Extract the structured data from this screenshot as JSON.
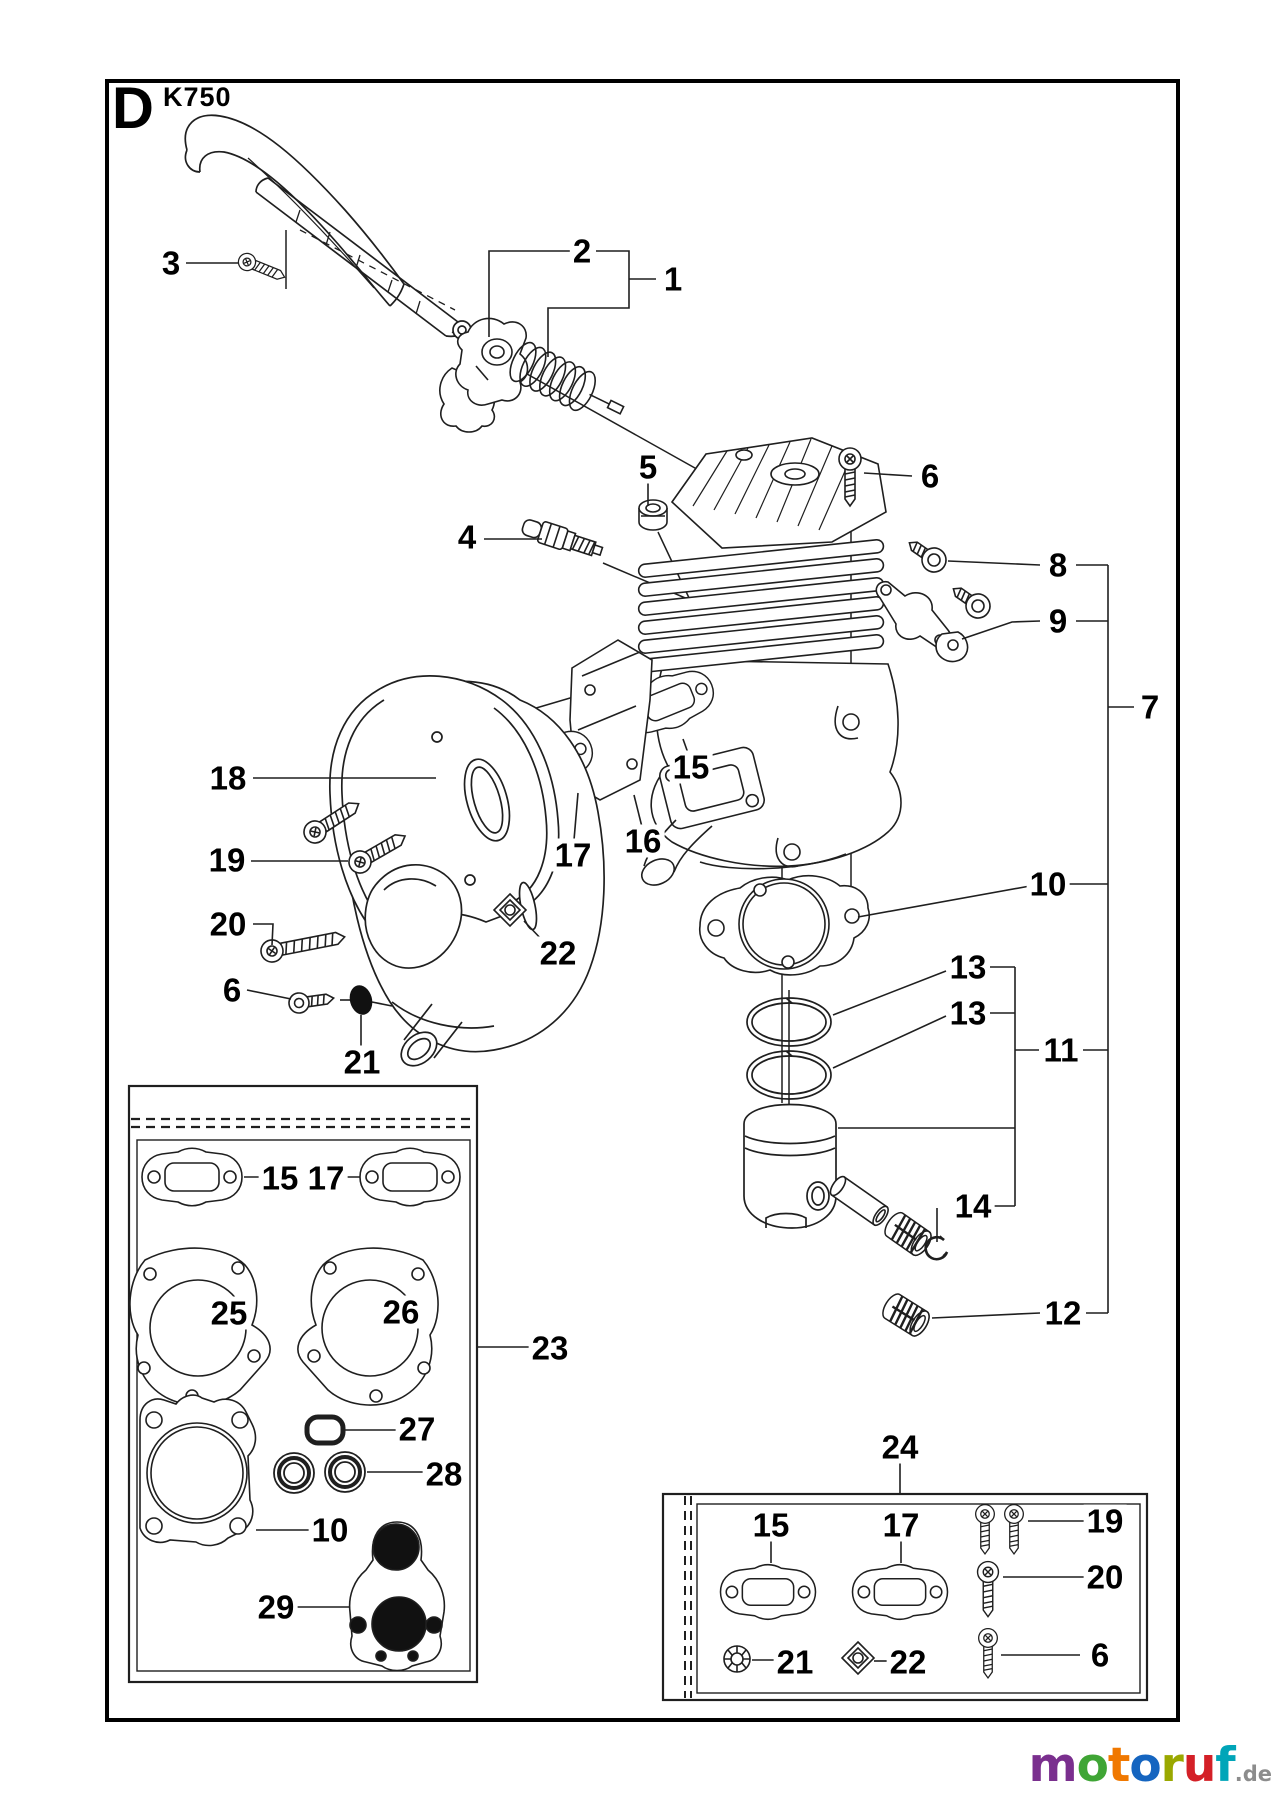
{
  "sheet": {
    "letter": "D",
    "model": "K750"
  },
  "diagram": {
    "line_color": "#1f1f1f",
    "background": "#ffffff",
    "callouts": [
      {
        "n": "3",
        "x": 171,
        "y": 263
      },
      {
        "n": "2",
        "x": 582,
        "y": 251
      },
      {
        "n": "1",
        "x": 673,
        "y": 279
      },
      {
        "n": "5",
        "x": 648,
        "y": 467
      },
      {
        "n": "4",
        "x": 467,
        "y": 537
      },
      {
        "n": "6",
        "x": 930,
        "y": 476
      },
      {
        "n": "8",
        "x": 1058,
        "y": 565
      },
      {
        "n": "9",
        "x": 1058,
        "y": 621
      },
      {
        "n": "7",
        "x": 1150,
        "y": 707
      },
      {
        "n": "15",
        "x": 691,
        "y": 767
      },
      {
        "n": "16",
        "x": 643,
        "y": 841
      },
      {
        "n": "17",
        "x": 573,
        "y": 855
      },
      {
        "n": "18",
        "x": 228,
        "y": 778
      },
      {
        "n": "19",
        "x": 227,
        "y": 860
      },
      {
        "n": "20",
        "x": 228,
        "y": 924
      },
      {
        "n": "6",
        "x": 232,
        "y": 990
      },
      {
        "n": "21",
        "x": 362,
        "y": 1062
      },
      {
        "n": "22",
        "x": 558,
        "y": 953
      },
      {
        "n": "10",
        "x": 1048,
        "y": 884
      },
      {
        "n": "13",
        "x": 968,
        "y": 967
      },
      {
        "n": "13",
        "x": 968,
        "y": 1013
      },
      {
        "n": "11",
        "x": 1061,
        "y": 1050
      },
      {
        "n": "14",
        "x": 973,
        "y": 1206
      },
      {
        "n": "12",
        "x": 1063,
        "y": 1313
      },
      {
        "n": "23",
        "x": 550,
        "y": 1348
      },
      {
        "n": "24",
        "x": 900,
        "y": 1447
      },
      {
        "n": "15",
        "x": 280,
        "y": 1178
      },
      {
        "n": "17",
        "x": 326,
        "y": 1178
      },
      {
        "n": "25",
        "x": 229,
        "y": 1313
      },
      {
        "n": "26",
        "x": 401,
        "y": 1312
      },
      {
        "n": "27",
        "x": 417,
        "y": 1429
      },
      {
        "n": "28",
        "x": 444,
        "y": 1474
      },
      {
        "n": "10",
        "x": 330,
        "y": 1530
      },
      {
        "n": "29",
        "x": 276,
        "y": 1607
      },
      {
        "n": "15",
        "x": 771,
        "y": 1525
      },
      {
        "n": "17",
        "x": 901,
        "y": 1525
      },
      {
        "n": "19",
        "x": 1105,
        "y": 1521
      },
      {
        "n": "20",
        "x": 1105,
        "y": 1577
      },
      {
        "n": "6",
        "x": 1100,
        "y": 1655
      },
      {
        "n": "21",
        "x": 795,
        "y": 1662
      },
      {
        "n": "22",
        "x": 908,
        "y": 1662
      }
    ]
  },
  "watermark": {
    "letters": [
      {
        "ch": "m",
        "color": "#7a2f8e"
      },
      {
        "ch": "o",
        "color": "#3fa535"
      },
      {
        "ch": "t",
        "color": "#f07800"
      },
      {
        "ch": "o",
        "color": "#1565c0"
      },
      {
        "ch": "r",
        "color": "#9aa800"
      },
      {
        "ch": "u",
        "color": "#d42027"
      },
      {
        "ch": "f",
        "color": "#00a5b8"
      }
    ],
    "tld": ".de",
    "tld_color": "#8c8c8c"
  }
}
